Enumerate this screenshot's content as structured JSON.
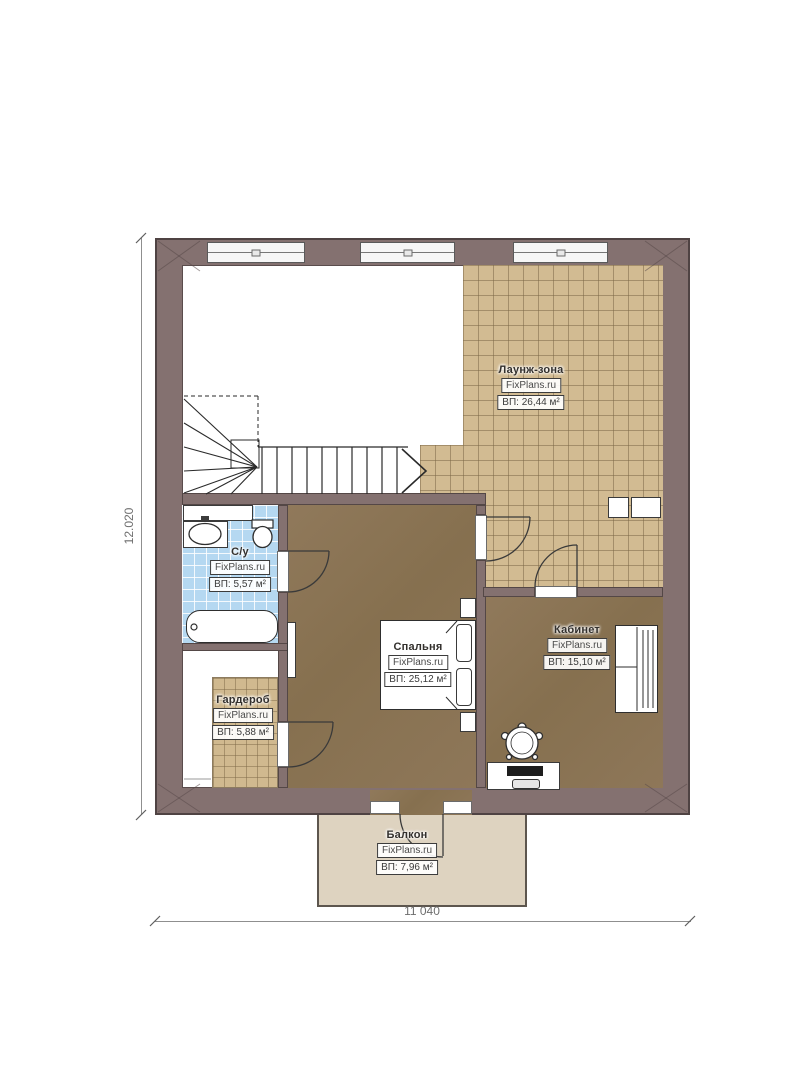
{
  "plan": {
    "type": "floor-plan",
    "floor_note": "second floor plan with lounge, bedroom, office, bathroom, wardrobe and balcony"
  },
  "dimensions": {
    "left": "12.020",
    "bottom": "11 040"
  },
  "watermark": "FixPlans.ru",
  "rooms": {
    "lounge": {
      "name": "Лаунж-зона",
      "watermark": "FixPlans.ru",
      "area": "ВП: 26,44 м²"
    },
    "bathroom": {
      "name": "С/у",
      "watermark": "FixPlans.ru",
      "area": "ВП: 5,57 м²"
    },
    "bedroom": {
      "name": "Спальня",
      "watermark": "FixPlans.ru",
      "area": "ВП: 25,12 м²"
    },
    "office": {
      "name": "Кабинет",
      "watermark": "FixPlans.ru",
      "area": "ВП: 15,10 м²"
    },
    "wardrobe": {
      "name": "Гардероб",
      "watermark": "FixPlans.ru",
      "area": "ВП: 5,88 м²"
    },
    "balcony": {
      "name": "Балкон",
      "watermark": "FixPlans.ru",
      "area": "ВП: 7,96 м²"
    }
  },
  "colors": {
    "wall": "#847170",
    "wall_edge": "#4f4343",
    "tile": "#d2bb92",
    "tile_grid": "#7d6a48",
    "floor_wood": "#8b7457",
    "bath_tile": "#b5d8f1",
    "balcony": "#ded3c0",
    "line": "#2f2f2f",
    "dim_text": "#6e6e6e"
  }
}
